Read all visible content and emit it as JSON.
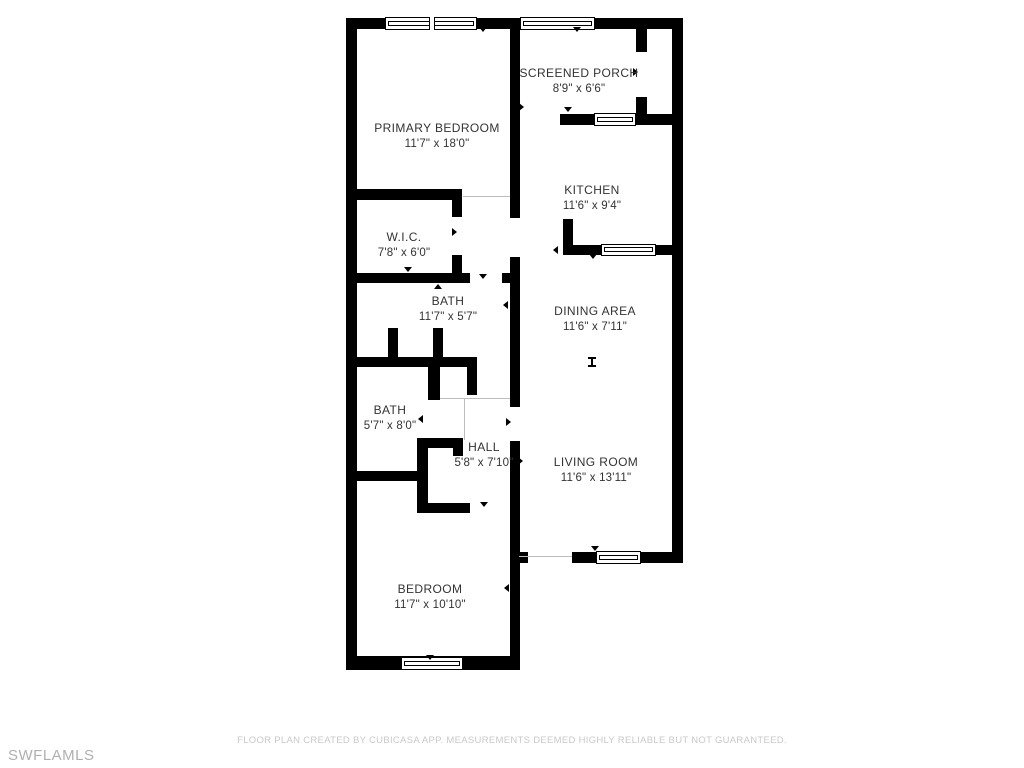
{
  "plan": {
    "rooms": [
      {
        "name": "PRIMARY BEDROOM",
        "dims": "11'7\" x 18'0\""
      },
      {
        "name": "SCREENED PORCH",
        "dims": "8'9\" x 6'6\""
      },
      {
        "name": "KITCHEN",
        "dims": "11'6\" x 9'4\""
      },
      {
        "name": "W.I.C.",
        "dims": "7'8\" x 6'0\""
      },
      {
        "name": "BATH",
        "dims": "11'7\" x 5'7\""
      },
      {
        "name": "DINING AREA",
        "dims": "11'6\" x 7'11\""
      },
      {
        "name": "BATH",
        "dims": "5'7\" x 8'0\""
      },
      {
        "name": "HALL",
        "dims": "5'8\" x 7'10\""
      },
      {
        "name": "LIVING ROOM",
        "dims": "11'6\" x 13'11\""
      },
      {
        "name": "BEDROOM",
        "dims": "11'7\" x 10'10\""
      }
    ]
  },
  "footer": {
    "disclaimer": "FLOOR PLAN CREATED BY CUBICASA APP. MEASUREMENTS DEEMED HIGHLY RELIABLE BUT NOT GUARANTEED."
  },
  "watermark": {
    "text": "SWFLAMLS"
  },
  "colors": {
    "wall": "#000000",
    "label_text": "#333333",
    "footer_text": "#c9c9c9",
    "watermark_text": "#b0b0b0",
    "background": "#ffffff"
  }
}
